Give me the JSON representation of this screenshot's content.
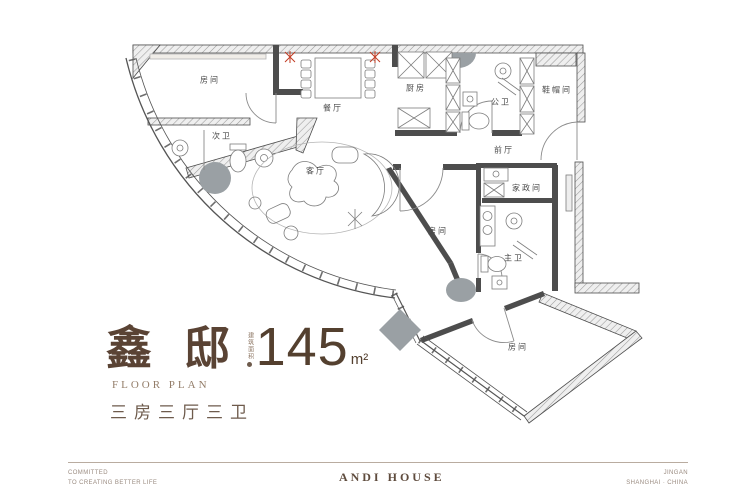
{
  "plan": {
    "rooms": [
      {
        "id": "bedroom-top-left",
        "label": "房间"
      },
      {
        "id": "second-bath",
        "label": "次卫"
      },
      {
        "id": "dining",
        "label": "餐厅"
      },
      {
        "id": "living",
        "label": "客厅"
      },
      {
        "id": "kitchen",
        "label": "厨房"
      },
      {
        "id": "public-bath",
        "label": "公卫"
      },
      {
        "id": "cloakroom",
        "label": "鞋帽间"
      },
      {
        "id": "front-hall",
        "label": "前厅"
      },
      {
        "id": "housekeeping",
        "label": "家政间"
      },
      {
        "id": "bedroom-middle",
        "label": "房间"
      },
      {
        "id": "master-bath",
        "label": "主卫"
      },
      {
        "id": "bedroom-bottom",
        "label": "房间"
      }
    ]
  },
  "title": {
    "name": "鑫邸",
    "floor_plan_label": "FLOOR PLAN",
    "layout_label": "三房三厅三卫",
    "area_prefix": "建筑面积",
    "area_value": "145",
    "area_unit": "m²"
  },
  "footer": {
    "left_line1": "COMMITTED",
    "left_line2": "TO CREATING BETTER LIFE",
    "center": "ANDI HOUSE",
    "right_line1": "JINGAN",
    "right_line2": "SHANGHAI · CHINA"
  },
  "colors": {
    "accent_brown": "#5a4334",
    "line_gray": "#4d4d4d",
    "column_gray": "#9aa0a4",
    "marker_red": "#c23b22"
  }
}
